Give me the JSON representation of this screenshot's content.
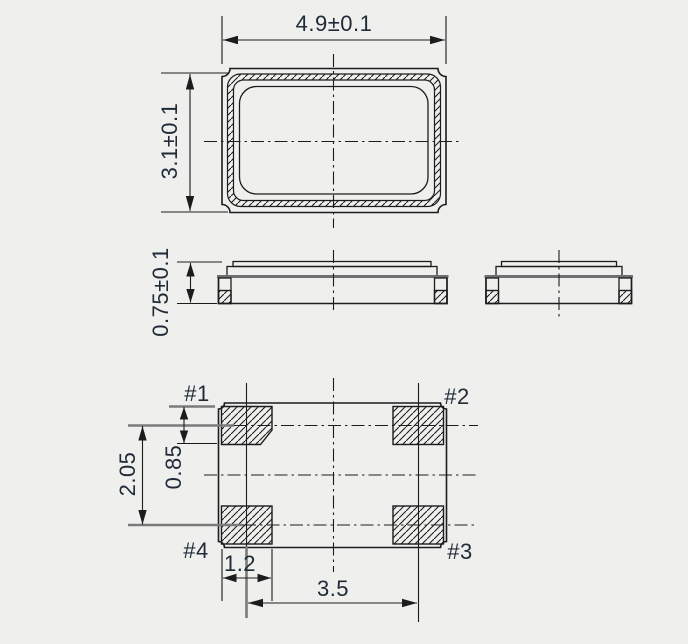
{
  "page": {
    "background": "#efefee"
  },
  "drawing": {
    "kind": "package-dimension-drawing",
    "views": {
      "top": {
        "width_dim": "4.9±0.1",
        "height_dim": "3.1±0.1"
      },
      "side": {
        "height_dim": "0.75±0.1"
      },
      "land_pattern": {
        "pads": [
          "#1",
          "#2",
          "#3",
          "#4"
        ],
        "pad_height_dim": "0.85",
        "row_pitch_dim": "2.05",
        "pad_width_dim": "1.2",
        "column_pitch_dim": "3.5"
      }
    },
    "colors": {
      "line": "#1c1c1c",
      "gray_extension_line": "#7b7b7b",
      "text": "#202b38",
      "background": "#efefee"
    }
  }
}
